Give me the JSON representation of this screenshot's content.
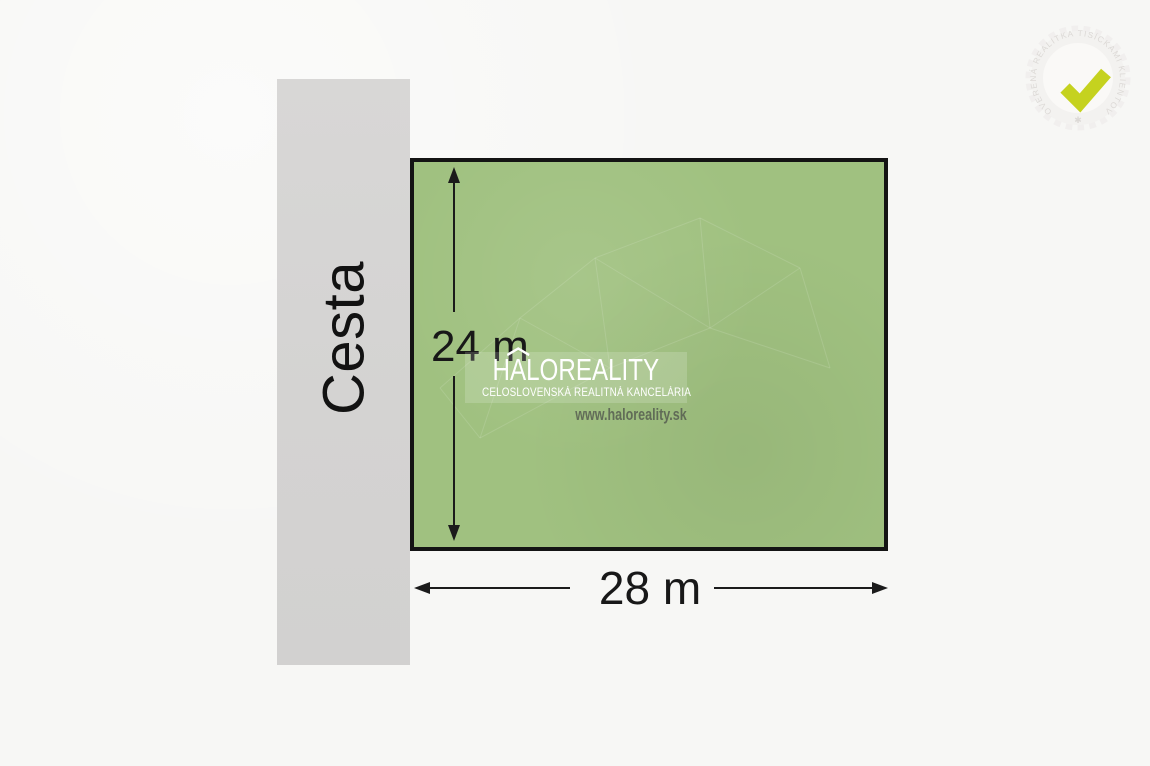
{
  "scene": {
    "background_color": "#f7f7f5"
  },
  "road": {
    "label": "Cesta",
    "color": "#d5d4d3"
  },
  "plot": {
    "fill_color": "#a0c180",
    "border_color": "#141414"
  },
  "dimensions": {
    "height_label": "24 m",
    "width_label": "28 m"
  },
  "watermark": {
    "brand_prefix": "H",
    "brand_accent_letter": "A",
    "brand_suffix": "LOREALITY",
    "roof_icon": "house-roof-icon",
    "subtitle": "CELOSLOVENSKÁ REALITNÁ KANCELÁRIA",
    "website": "www.haloreality.sk"
  },
  "badge": {
    "ring_text": "OVERENÁ REALITKA TISÍCKAMI KLIENTOV",
    "star": "✱",
    "icon": "checkmark-icon",
    "check_color": "#c5d21f"
  }
}
